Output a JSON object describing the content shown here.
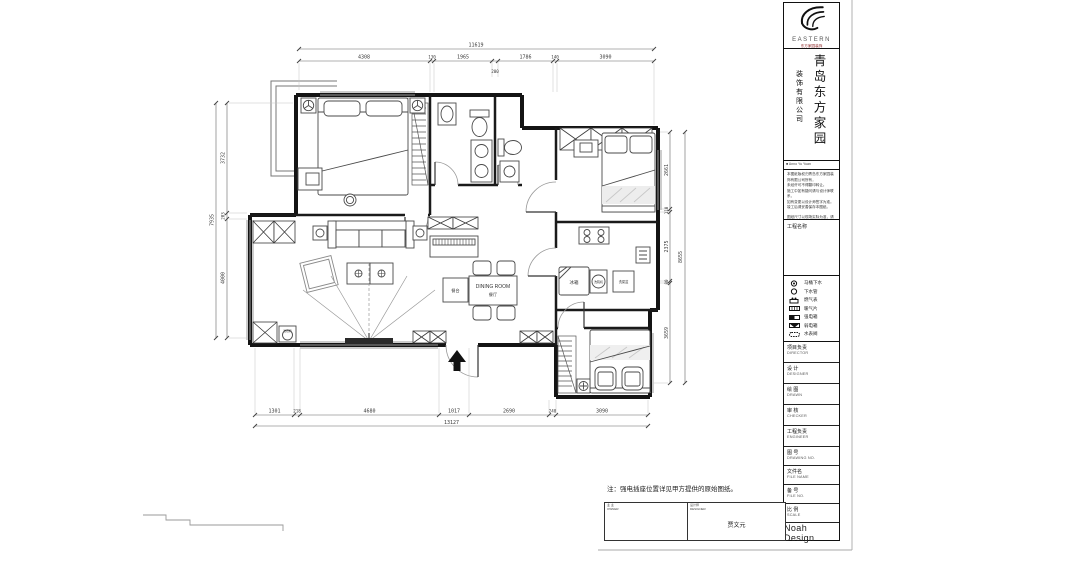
{
  "panel": {
    "brand": "EASTERN",
    "brand_sub": "东方家园装饰",
    "company_main": "青岛东方家园",
    "company_sub": "装饰有限公司",
    "tagline": "■ Anno Yu Yuan",
    "notes": [
      "本图纸版权归青岛东方家园装饰有限公司所有，",
      "未经许可不得翻印转让。",
      "施工中如有疑问请与设计师联系，",
      "如有变更以设计师签字为准。",
      "竣工后请妥善保存本图纸。"
    ],
    "notes_footer": "图纸尺寸以现场实际为准，请核对无误后施工。",
    "project_label": "工程名称",
    "legend": [
      {
        "label": "马桶下水"
      },
      {
        "label": "下水管"
      },
      {
        "label": "燃气表"
      },
      {
        "label": "暖气片"
      },
      {
        "label": "强电箱"
      },
      {
        "label": "弱电箱"
      },
      {
        "label": "水表阀"
      }
    ],
    "rows": [
      {
        "cn": "项目负责",
        "en": "DIRECTOR"
      },
      {
        "cn": "设 计",
        "en": "DESIGNER"
      },
      {
        "cn": "绘 图",
        "en": "DRAWN"
      },
      {
        "cn": "审 核",
        "en": "CHECKER"
      },
      {
        "cn": "工程负责",
        "en": "ENGINEER"
      },
      {
        "cn": "图 号",
        "en": "DRAWING NO."
      },
      {
        "cn": "文件名",
        "en": "FILE NAME"
      },
      {
        "cn": "备 号",
        "en": "FILE NO."
      },
      {
        "cn": "比 例",
        "en": "SCALE"
      }
    ],
    "brand_bottom": "Noah Design"
  },
  "plan": {
    "labels": {
      "dining_en": "DINING ROOM",
      "dining_cn": "餐厅",
      "fridge": "冰箱",
      "kitchen_washer": "洗碗机",
      "sink": "洗菜盆",
      "cabinet": "餐台",
      "corner_washer": "洗衣机"
    },
    "note": "注：强电插座位置详见甲方提供的原始图纸。",
    "dims": {
      "top": {
        "total": "11619",
        "segs": [
          "4308",
          "130",
          "1965",
          "1786",
          "140",
          "3090"
        ],
        "inner": "200"
      },
      "bottom": {
        "total": "13127",
        "segs": [
          "1301",
          "218",
          "4680",
          "1017",
          "2690",
          "240",
          "3090"
        ]
      },
      "left": {
        "total": "7935",
        "segs": [
          "3732",
          "203",
          "4000"
        ]
      },
      "right": {
        "total": "8655",
        "segs": [
          "2661",
          "110",
          "2375",
          "80",
          "3659"
        ]
      }
    }
  },
  "sign": {
    "left_l1": "业 主",
    "left_l2": "OWNER",
    "right_l1": "设计师",
    "right_l2": "DESIGNER",
    "name": "贾文元"
  }
}
